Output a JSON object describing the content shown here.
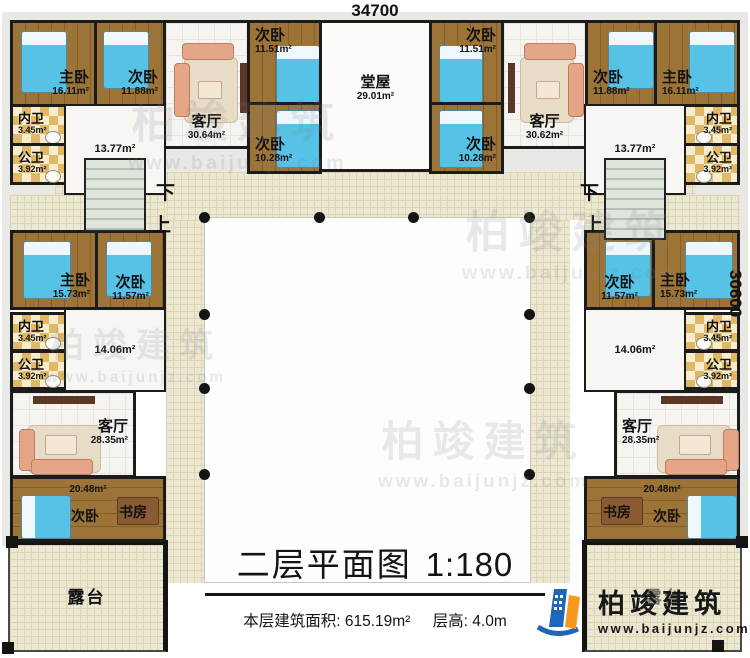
{
  "dimensions": {
    "top": "34700",
    "right": "30600"
  },
  "title": {
    "main": "二层平面图",
    "scale": "1:180",
    "area_label": "本层建筑面积:",
    "area_value": "615.19m²",
    "height_label": "层高:",
    "height_value": "4.0m"
  },
  "brand": {
    "name": "柏竣建筑",
    "url": "www.baijunjz.com"
  },
  "watermark": {
    "name": "柏竣建筑",
    "url": "www.baijunjz.com"
  },
  "stairs": {
    "down": "下",
    "up": "上"
  },
  "colors": {
    "wall": "#1b1b1b",
    "wood_floor": "#9d7437",
    "bed_blue": "#56c2e5",
    "bath_checker": "#e0b968",
    "corridor_tan": "#ebe7d1",
    "sofa_salmon": "#e5a586",
    "brand_blue": "#1f66b8",
    "brand_orange": "#f59a1f"
  },
  "rooms": {
    "top_left_master": {
      "label": "主卧",
      "area": "16.11m²"
    },
    "top_left_bed2": {
      "label": "次卧",
      "area": "11.88m²"
    },
    "top_left_bath_inner": {
      "label": "内卫",
      "area": "3.45m²"
    },
    "top_left_bath_public": {
      "label": "公卫",
      "area": "3.92m²"
    },
    "top_left_hall": {
      "area": "13.77m²"
    },
    "top_left_living": {
      "label": "客厅",
      "area": "30.64m²"
    },
    "top_left_bed3": {
      "label": "次卧",
      "area": "11.51m²"
    },
    "top_left_bed4": {
      "label": "次卧",
      "area": "10.28m²"
    },
    "main_hall": {
      "label": "堂屋",
      "area": "29.01m²"
    },
    "top_right_bed3": {
      "label": "次卧",
      "area": "11.51m²"
    },
    "top_right_bed4": {
      "label": "次卧",
      "area": "10.28m²"
    },
    "top_right_living": {
      "label": "客厅",
      "area": "30.62m²"
    },
    "top_right_bed2": {
      "label": "次卧",
      "area": "11.88m²"
    },
    "top_right_master": {
      "label": "主卧",
      "area": "16.11m²"
    },
    "top_right_bath_inner": {
      "label": "内卫",
      "area": "3.45m²"
    },
    "top_right_bath_public": {
      "label": "公卫",
      "area": "3.92m²"
    },
    "top_right_hall": {
      "area": "13.77m²"
    },
    "left_master": {
      "label": "主卧",
      "area": "15.73m²"
    },
    "left_bed2": {
      "label": "次卧",
      "area": "11.57m²"
    },
    "left_bath_inner": {
      "label": "内卫",
      "area": "3.45m²"
    },
    "left_bath_public": {
      "label": "公卫",
      "area": "3.92m²"
    },
    "left_hall": {
      "area": "14.06m²"
    },
    "left_living": {
      "label": "客厅",
      "area": "28.35m²"
    },
    "left_multi": {
      "area": "20.48m²",
      "bed_label": "次卧",
      "study_label": "书房"
    },
    "left_terrace": {
      "label": "露台"
    },
    "right_bed2": {
      "label": "次卧",
      "area": "11.57m²"
    },
    "right_master": {
      "label": "主卧",
      "area": "15.73m²"
    },
    "right_bath_inner": {
      "label": "内卫",
      "area": "3.45m²"
    },
    "right_bath_public": {
      "label": "公卫",
      "area": "3.92m²"
    },
    "right_hall": {
      "area": "14.06m²"
    },
    "right_living": {
      "label": "客厅",
      "area": "28.35m²"
    },
    "right_multi": {
      "area": "20.48m²",
      "study_label": "书房",
      "bed_label": "次卧"
    },
    "right_terrace": {
      "label": "露台"
    }
  }
}
